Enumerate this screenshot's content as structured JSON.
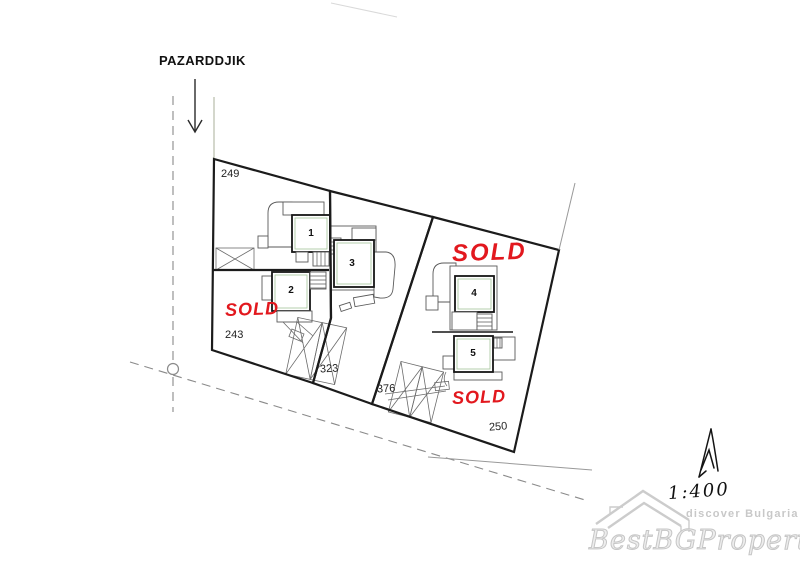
{
  "map": {
    "road_label": "PAZARDDJIK",
    "plot_labels": {
      "p249": "249",
      "p243": "243",
      "p323": "323",
      "p376": "376",
      "p250": "250"
    },
    "house_labels": {
      "h1": "1",
      "h2": "2",
      "h3": "3",
      "h4": "4",
      "h5": "5"
    },
    "sold_labels": [
      {
        "text": "SOLD"
      },
      {
        "text": "SOLD"
      },
      {
        "text": "SOLD"
      }
    ],
    "scale_label": "1:400",
    "colors": {
      "sold_red": "#e2181e",
      "boundary_black": "#1b1b1b",
      "plan_green_tint": "#a3c49a",
      "watermark_gray": "#c8c8c8"
    }
  },
  "watermark": {
    "tagline": "discover Bulgaria",
    "brand": "BestBGProperties"
  },
  "icons": {
    "direction_arrow": "down-arrow",
    "survey_point": "open-circle-node",
    "north_arrow": "hand-drawn-north-arrow",
    "roof_logo": "house-roof-outline",
    "parking_cross": "x-crossed-rectangle"
  }
}
